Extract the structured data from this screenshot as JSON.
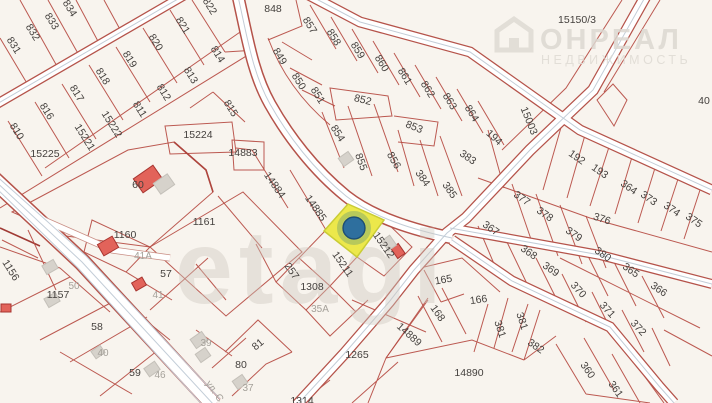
{
  "map": {
    "colors": {
      "background": "#f8f4ee",
      "parcel_line": "#b5483f",
      "road_fill": "#ffffff",
      "label": "#45413e",
      "muted_label": "#a5a19a",
      "selected_parcel_fill": "#ece84b",
      "selected_parcel_stroke": "#c9cc35",
      "marker_fill": "#2e6f9e",
      "marker_stroke": "#1d4f74",
      "red_building_fill": "#e2635a",
      "red_building_stroke": "#a83530",
      "gray_building_fill": "#d6d2cb"
    },
    "selected_parcel": {
      "label": "15211",
      "points": "348,204 384,220 357,257 324,231"
    },
    "marker": {
      "cx": 354,
      "cy": 228,
      "r": 11
    },
    "watermark_center": {
      "text": "etagi"
    },
    "watermark_corner": {
      "line1": "ОНРЕАЛ",
      "line2": "НЕДВИЖИМОСТЬ",
      "icon": "house-logo"
    },
    "street_label": {
      "text": "ул. С",
      "x": 212,
      "y": 393,
      "rot": 55
    },
    "labels": [
      {
        "t": "834",
        "x": 67,
        "y": 10,
        "r": 58
      },
      {
        "t": "833",
        "x": 49,
        "y": 23,
        "r": 58
      },
      {
        "t": "832",
        "x": 30,
        "y": 34,
        "r": 58
      },
      {
        "t": "831",
        "x": 11,
        "y": 47,
        "r": 58
      },
      {
        "t": "822",
        "x": 207,
        "y": 8,
        "r": 58
      },
      {
        "t": "821",
        "x": 180,
        "y": 27,
        "r": 58
      },
      {
        "t": "820",
        "x": 153,
        "y": 44,
        "r": 58
      },
      {
        "t": "819",
        "x": 127,
        "y": 61,
        "r": 58
      },
      {
        "t": "818",
        "x": 100,
        "y": 78,
        "r": 58
      },
      {
        "t": "817",
        "x": 74,
        "y": 95,
        "r": 58
      },
      {
        "t": "816",
        "x": 44,
        "y": 113,
        "r": 58
      },
      {
        "t": "810",
        "x": 14,
        "y": 133,
        "r": 58
      },
      {
        "t": "814",
        "x": 215,
        "y": 56,
        "r": 58
      },
      {
        "t": "813",
        "x": 188,
        "y": 77,
        "r": 58
      },
      {
        "t": "812",
        "x": 161,
        "y": 94,
        "r": 58
      },
      {
        "t": "811",
        "x": 137,
        "y": 111,
        "r": 58
      },
      {
        "t": "15222",
        "x": 109,
        "y": 126,
        "r": 58
      },
      {
        "t": "15221",
        "x": 82,
        "y": 139,
        "r": 58
      },
      {
        "t": "15225",
        "x": 45,
        "y": 157,
        "r": 0
      },
      {
        "t": "815",
        "x": 228,
        "y": 110,
        "r": 58
      },
      {
        "t": "15224",
        "x": 198,
        "y": 138,
        "r": 0
      },
      {
        "t": "14883",
        "x": 243,
        "y": 156,
        "r": 0
      },
      {
        "t": "848",
        "x": 273,
        "y": 12,
        "r": 0
      },
      {
        "t": "857",
        "x": 307,
        "y": 27,
        "r": 58
      },
      {
        "t": "858",
        "x": 331,
        "y": 39,
        "r": 58
      },
      {
        "t": "859",
        "x": 355,
        "y": 52,
        "r": 58
      },
      {
        "t": "860",
        "x": 379,
        "y": 65,
        "r": 58
      },
      {
        "t": "861",
        "x": 402,
        "y": 78,
        "r": 58
      },
      {
        "t": "862",
        "x": 425,
        "y": 91,
        "r": 58
      },
      {
        "t": "863",
        "x": 447,
        "y": 103,
        "r": 58
      },
      {
        "t": "864",
        "x": 469,
        "y": 115,
        "r": 58
      },
      {
        "t": "849",
        "x": 277,
        "y": 58,
        "r": 58
      },
      {
        "t": "850",
        "x": 296,
        "y": 83,
        "r": 58
      },
      {
        "t": "851",
        "x": 315,
        "y": 97,
        "r": 58
      },
      {
        "t": "852",
        "x": 362,
        "y": 103,
        "r": 14
      },
      {
        "t": "853",
        "x": 413,
        "y": 130,
        "r": 22
      },
      {
        "t": "854",
        "x": 335,
        "y": 135,
        "r": 58
      },
      {
        "t": "855",
        "x": 358,
        "y": 163,
        "r": 70
      },
      {
        "t": "856",
        "x": 391,
        "y": 162,
        "r": 60
      },
      {
        "t": "384",
        "x": 420,
        "y": 180,
        "r": 55
      },
      {
        "t": "385",
        "x": 447,
        "y": 192,
        "r": 55
      },
      {
        "t": "383",
        "x": 466,
        "y": 160,
        "r": 35
      },
      {
        "t": "194",
        "x": 492,
        "y": 140,
        "r": 42
      },
      {
        "t": "15003",
        "x": 526,
        "y": 122,
        "r": 68
      },
      {
        "t": "15150/3",
        "x": 577,
        "y": 23,
        "r": 0
      },
      {
        "t": "40",
        "x": 704,
        "y": 104,
        "r": 0
      },
      {
        "t": "192",
        "x": 575,
        "y": 160,
        "r": 35
      },
      {
        "t": "193",
        "x": 598,
        "y": 174,
        "r": 35
      },
      {
        "t": "364",
        "x": 627,
        "y": 190,
        "r": 35
      },
      {
        "t": "373",
        "x": 647,
        "y": 201,
        "r": 35
      },
      {
        "t": "374",
        "x": 670,
        "y": 212,
        "r": 35
      },
      {
        "t": "375",
        "x": 692,
        "y": 223,
        "r": 35
      },
      {
        "t": "377",
        "x": 520,
        "y": 201,
        "r": 35
      },
      {
        "t": "378",
        "x": 543,
        "y": 217,
        "r": 35
      },
      {
        "t": "379",
        "x": 572,
        "y": 237,
        "r": 35
      },
      {
        "t": "376",
        "x": 601,
        "y": 222,
        "r": 18
      },
      {
        "t": "367",
        "x": 489,
        "y": 231,
        "r": 35
      },
      {
        "t": "368",
        "x": 527,
        "y": 255,
        "r": 35
      },
      {
        "t": "369",
        "x": 549,
        "y": 272,
        "r": 35
      },
      {
        "t": "370",
        "x": 576,
        "y": 292,
        "r": 48
      },
      {
        "t": "371",
        "x": 605,
        "y": 312,
        "r": 48
      },
      {
        "t": "372",
        "x": 636,
        "y": 330,
        "r": 48
      },
      {
        "t": "380",
        "x": 601,
        "y": 257,
        "r": 35
      },
      {
        "t": "365",
        "x": 629,
        "y": 273,
        "r": 35
      },
      {
        "t": "366",
        "x": 657,
        "y": 292,
        "r": 35
      },
      {
        "t": "360",
        "x": 585,
        "y": 372,
        "r": 55
      },
      {
        "t": "361",
        "x": 613,
        "y": 391,
        "r": 55
      },
      {
        "t": "381",
        "x": 497,
        "y": 330,
        "r": 72
      },
      {
        "t": "381",
        "x": 519,
        "y": 322,
        "r": 72
      },
      {
        "t": "382",
        "x": 534,
        "y": 349,
        "r": 35
      },
      {
        "t": "14890",
        "x": 469,
        "y": 376,
        "r": 0
      },
      {
        "t": "165",
        "x": 444,
        "y": 283,
        "r": -10
      },
      {
        "t": "166",
        "x": 479,
        "y": 303,
        "r": -8
      },
      {
        "t": "168",
        "x": 435,
        "y": 315,
        "r": 55
      },
      {
        "t": "14889",
        "x": 407,
        "y": 337,
        "r": 42
      },
      {
        "t": "14884",
        "x": 272,
        "y": 187,
        "r": 55
      },
      {
        "t": "14885",
        "x": 313,
        "y": 210,
        "r": 55
      },
      {
        "t": "15211",
        "x": 340,
        "y": 266,
        "r": 55
      },
      {
        "t": "15212",
        "x": 381,
        "y": 247,
        "r": 55
      },
      {
        "t": "257",
        "x": 289,
        "y": 273,
        "r": 55
      },
      {
        "t": "1308",
        "x": 312,
        "y": 290,
        "r": 0
      },
      {
        "t": "35А",
        "x": 320,
        "y": 312,
        "r": 0,
        "m": true
      },
      {
        "t": "1265",
        "x": 357,
        "y": 358,
        "r": 0
      },
      {
        "t": "1314",
        "x": 302,
        "y": 404,
        "r": 0
      },
      {
        "t": "60",
        "x": 138,
        "y": 188,
        "r": 0
      },
      {
        "t": "1161",
        "x": 204,
        "y": 225,
        "r": 0
      },
      {
        "t": "1160",
        "x": 125,
        "y": 238,
        "r": 0
      },
      {
        "t": "41А",
        "x": 143,
        "y": 259,
        "r": 0,
        "m": true
      },
      {
        "t": "57",
        "x": 166,
        "y": 277,
        "r": 0
      },
      {
        "t": "41",
        "x": 158,
        "y": 298,
        "r": 0,
        "m": true
      },
      {
        "t": "50",
        "x": 74,
        "y": 289,
        "r": 0,
        "m": true
      },
      {
        "t": "1157",
        "x": 58,
        "y": 298,
        "r": 0
      },
      {
        "t": "1156",
        "x": 8,
        "y": 272,
        "r": 58
      },
      {
        "t": "58",
        "x": 97,
        "y": 330,
        "r": 0
      },
      {
        "t": "40",
        "x": 103,
        "y": 356,
        "r": 0,
        "m": true
      },
      {
        "t": "59",
        "x": 135,
        "y": 376,
        "r": 0
      },
      {
        "t": "46",
        "x": 160,
        "y": 378,
        "r": 0,
        "m": true
      },
      {
        "t": "39",
        "x": 206,
        "y": 346,
        "r": 0,
        "m": true
      },
      {
        "t": "37",
        "x": 248,
        "y": 391,
        "r": 0,
        "m": true
      },
      {
        "t": "81",
        "x": 260,
        "y": 347,
        "r": -40
      },
      {
        "t": "80",
        "x": 241,
        "y": 368,
        "r": 0
      }
    ],
    "buildings": [
      {
        "type": "red",
        "x": 148,
        "y": 179,
        "w": 24,
        "h": 17,
        "r": -35
      },
      {
        "type": "red",
        "x": 108,
        "y": 246,
        "w": 17,
        "h": 13,
        "r": -30
      },
      {
        "type": "red",
        "x": 139,
        "y": 284,
        "w": 12,
        "h": 9,
        "r": -30
      },
      {
        "type": "red",
        "x": 398,
        "y": 251,
        "w": 12,
        "h": 9,
        "r": 55
      },
      {
        "type": "red",
        "x": 6,
        "y": 308,
        "w": 10,
        "h": 8,
        "r": 0
      },
      {
        "type": "gray",
        "x": 164,
        "y": 184,
        "w": 17,
        "h": 13,
        "r": -35
      },
      {
        "type": "gray",
        "x": 50,
        "y": 267,
        "w": 13,
        "h": 10,
        "r": -30
      },
      {
        "type": "gray",
        "x": 52,
        "y": 300,
        "w": 13,
        "h": 10,
        "r": -30
      },
      {
        "type": "gray",
        "x": 199,
        "y": 340,
        "w": 14,
        "h": 11,
        "r": -35
      },
      {
        "type": "gray",
        "x": 152,
        "y": 369,
        "w": 13,
        "h": 10,
        "r": -35
      },
      {
        "type": "gray",
        "x": 240,
        "y": 382,
        "w": 12,
        "h": 10,
        "r": -35
      },
      {
        "type": "gray",
        "x": 203,
        "y": 355,
        "w": 12,
        "h": 10,
        "r": -35
      },
      {
        "type": "gray",
        "x": 389,
        "y": 243,
        "w": 12,
        "h": 10,
        "r": 55
      },
      {
        "type": "gray",
        "x": 346,
        "y": 159,
        "w": 12,
        "h": 10,
        "r": -35
      },
      {
        "type": "gray",
        "x": 98,
        "y": 352,
        "w": 11,
        "h": 9,
        "r": -35
      }
    ]
  }
}
